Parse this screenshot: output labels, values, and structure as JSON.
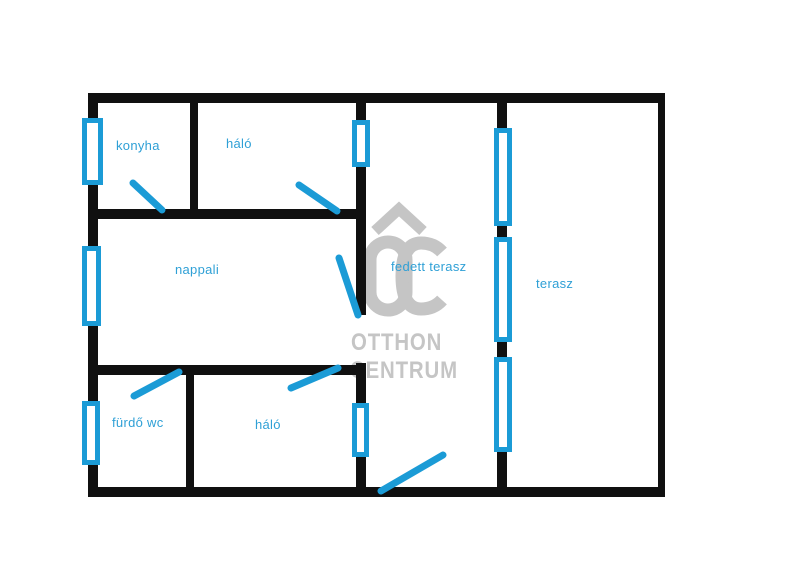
{
  "floor_plan": {
    "room_labels": {
      "konyha": "konyha",
      "halo_top": "háló",
      "nappali": "nappali",
      "furdo_wc": "fürdő wc",
      "halo_bottom": "háló",
      "fedett_terasz": "fedett terasz",
      "terasz": "terasz"
    },
    "watermark": {
      "logo": "OC",
      "line1": "OTTHON",
      "line2": "CENTRUM"
    },
    "colors": {
      "wall_black": "#101010",
      "plan_blue": "#1b9bd6",
      "label_blue": "#2fa0d6",
      "watermark_gray": "#c5c5c5"
    }
  }
}
